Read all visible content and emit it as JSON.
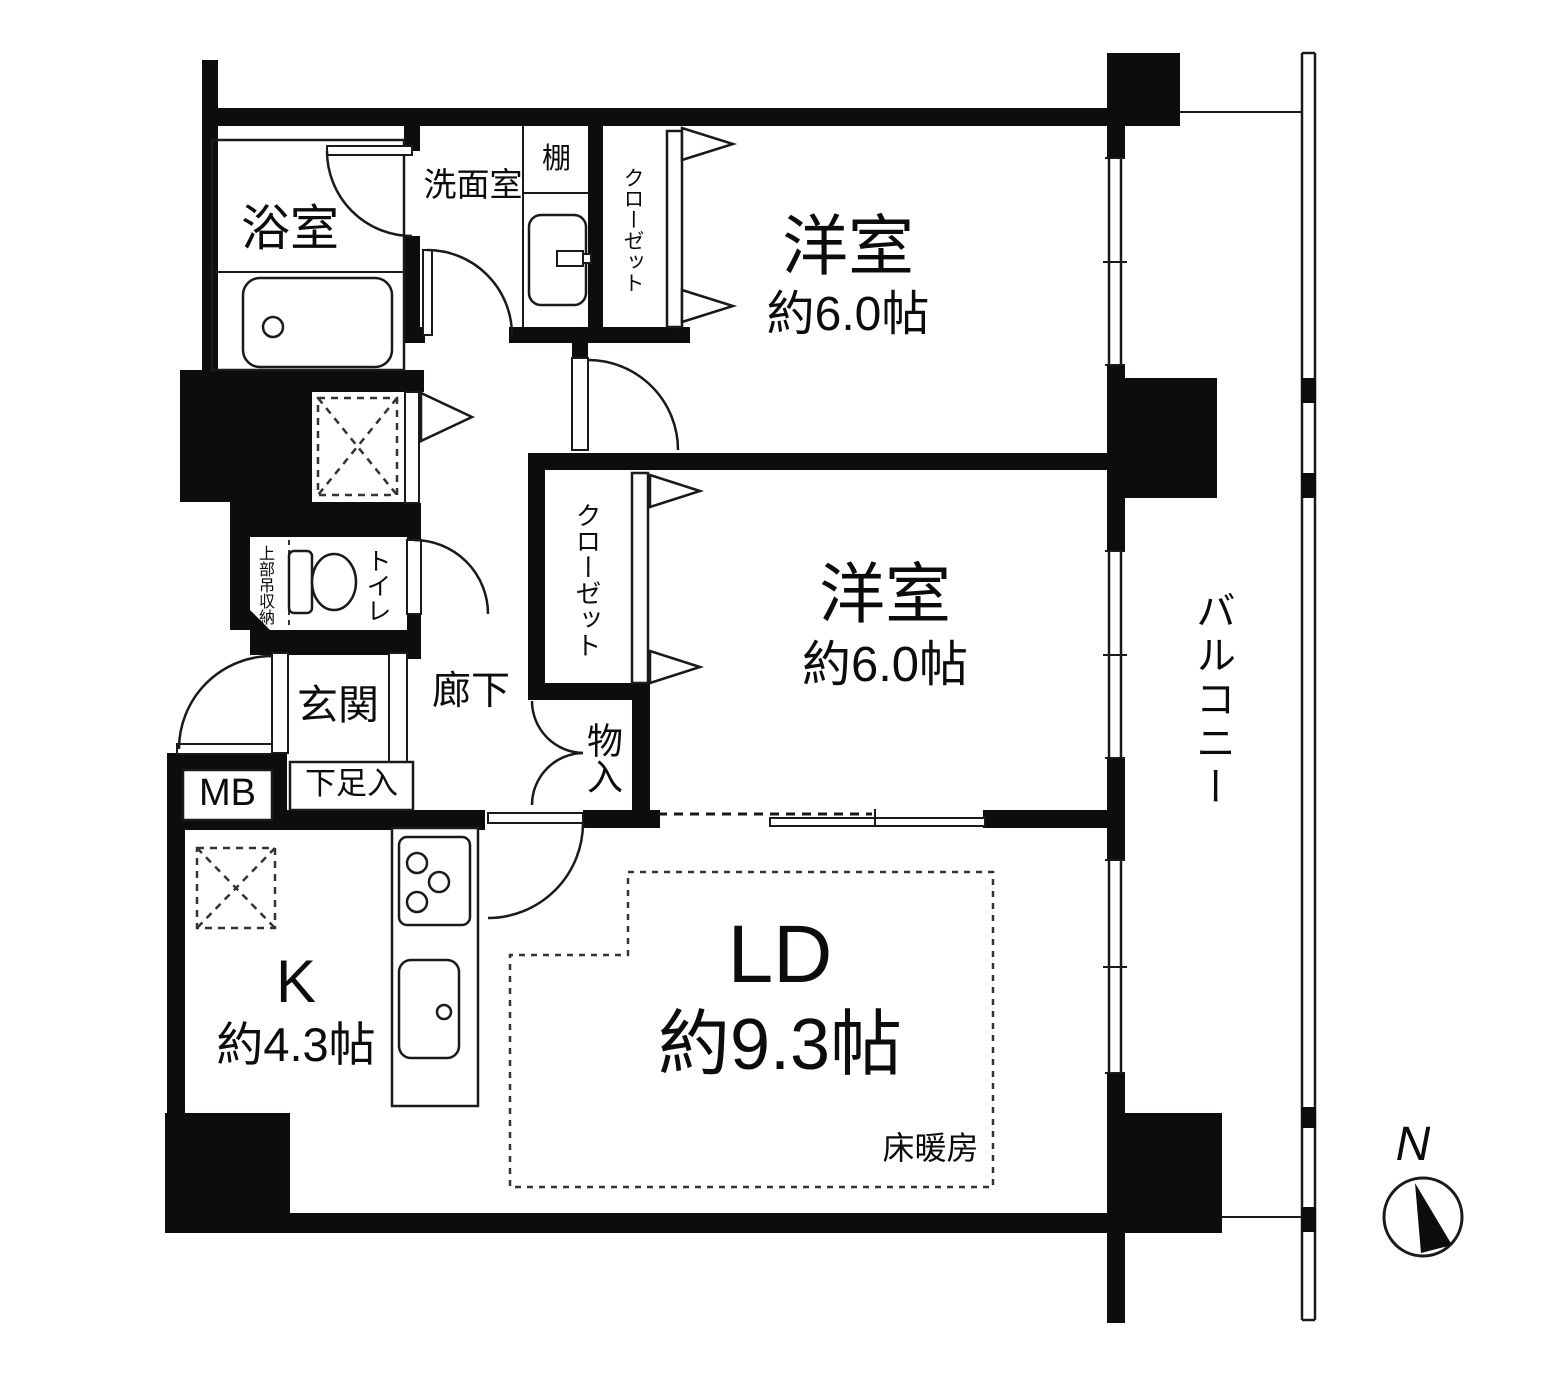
{
  "type": "japanese-apartment-floor-plan",
  "colors": {
    "wall": "#0e0c0d",
    "line": "#1a1a1a",
    "bg": "#ffffff",
    "dash": "#333333"
  },
  "compass": {
    "label": "N"
  },
  "balcony": {
    "label": "バルコニー"
  },
  "rooms": {
    "bathroom": {
      "label": "浴室"
    },
    "washroom": {
      "label": "洗面室",
      "shelf_label": "棚"
    },
    "closet_top": {
      "label": "クローゼット"
    },
    "bedroom_top": {
      "name": "洋室",
      "size": "約6.0帖"
    },
    "closet_mid": {
      "label": "クローゼット"
    },
    "bedroom_mid": {
      "name": "洋室",
      "size": "約6.0帖"
    },
    "storage": {
      "label": "物入"
    },
    "toilet": {
      "label": "トイレ",
      "upper_storage": "上部吊収納"
    },
    "hallway": {
      "label": "廊下"
    },
    "entrance": {
      "label": "玄関",
      "shoe_cabinet": "下足入",
      "meter_box": "MB"
    },
    "kitchen": {
      "name": "K",
      "size": "約4.3帖"
    },
    "living_dining": {
      "name": "LD",
      "size": "約9.3帖",
      "floor_heating": "床暖房"
    }
  }
}
